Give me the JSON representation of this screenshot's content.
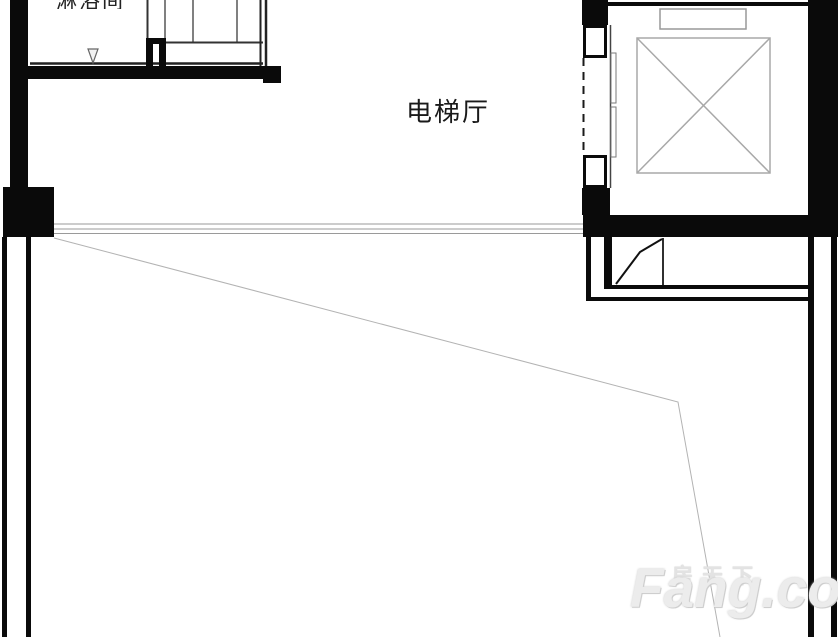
{
  "plan": {
    "labels": {
      "elevator_hall": "电梯厅",
      "shower_room_cropped": "淋浴间"
    },
    "watermark": {
      "cn": "房天下",
      "en": "Fang.com"
    },
    "icons": {
      "elevator_car": "elevator-car-x-icon",
      "counterweight": "elevator-counterweight-icon",
      "floor_slope": "triangle-drain-icon",
      "door_swing": "door-swing-line"
    },
    "colors": {
      "background": "#ffffff",
      "wall": "#0a0a0a",
      "thin_line": "#8a8a8a",
      "car_line": "#a8a8a8",
      "faint_line": "#b3b3b3",
      "watermark": "#dedede",
      "text": "#1a1a1a"
    }
  }
}
